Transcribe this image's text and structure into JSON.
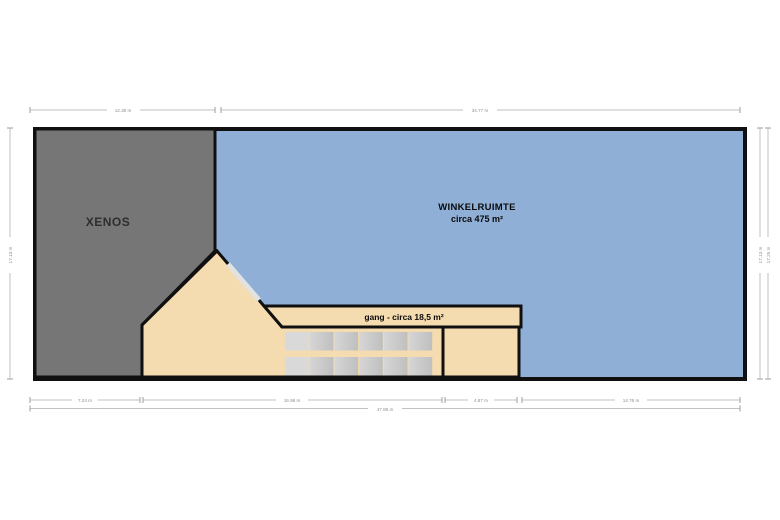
{
  "plan": {
    "title": "floorplan",
    "rooms": {
      "xenos": {
        "label": "XENOS"
      },
      "winkelruimte": {
        "label": "WINKELRUIMTE",
        "sublabel": "circa 475 m²"
      },
      "gang": {
        "label": "gang - circa 18,5 m²"
      }
    },
    "dimensions": {
      "top_left": "12.38 m",
      "top_right": "34.77 m",
      "left": "17.13 m",
      "right_inner": "17.13 m",
      "right_outer": "17.25 m",
      "bottom_seg1": "7.24 m",
      "bottom_seg2": "16.98 m",
      "bottom_seg3": "4.87 m",
      "bottom_seg4": "14.76 m",
      "bottom_total": "47.89 m"
    },
    "colors": {
      "xenos_fill": "#767676",
      "winkel_fill": "#8FAFD7",
      "gang_fill": "#F4DBB0",
      "wall": "#101010",
      "dim_line": "#c2c2c2",
      "dim_tick": "#9e9e9e",
      "dim_text": "#8f8f8f",
      "opening": "#e2e2e2",
      "stair_flat": "#d9d9d9",
      "stair_from": "#d6d6d6",
      "stair_to": "#bfbfbf",
      "background": "#ffffff"
    }
  }
}
